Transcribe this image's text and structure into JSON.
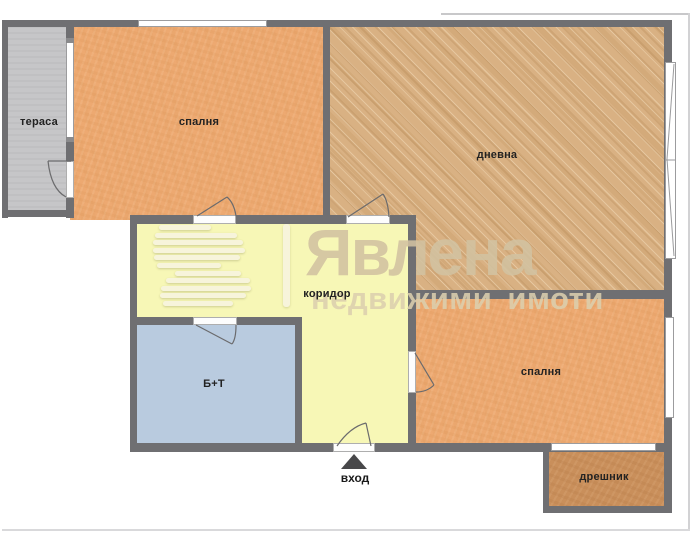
{
  "plan_title": "apartment-floor-plan",
  "rooms": [
    {
      "id": "terrace",
      "label": "тераса",
      "fill": "#c6c6c8"
    },
    {
      "id": "bedroom-top",
      "label": "спалня",
      "fill": "#eda971"
    },
    {
      "id": "living-room",
      "label": "дневна",
      "fill": "#d9b183"
    },
    {
      "id": "corridor",
      "label": "коридор",
      "fill": "#f7f7b6"
    },
    {
      "id": "bathroom",
      "label": "Б+Т",
      "fill": "#b9cbdf"
    },
    {
      "id": "bedroom-bottom",
      "label": "спалня",
      "fill": "#eda971"
    },
    {
      "id": "closet",
      "label": "дрешник",
      "fill": "#c98f5b"
    }
  ],
  "walls": {
    "color": "#6f6f72"
  },
  "windows": {
    "fill": "#ffffff"
  },
  "entrance": {
    "label": "вход",
    "arrow_color": "#48484a"
  },
  "watermark": {
    "brand": "Явлена",
    "tagline": "недвижими имоти",
    "text_color": "#d1c1a0",
    "mark_color": "#f6f3de"
  }
}
